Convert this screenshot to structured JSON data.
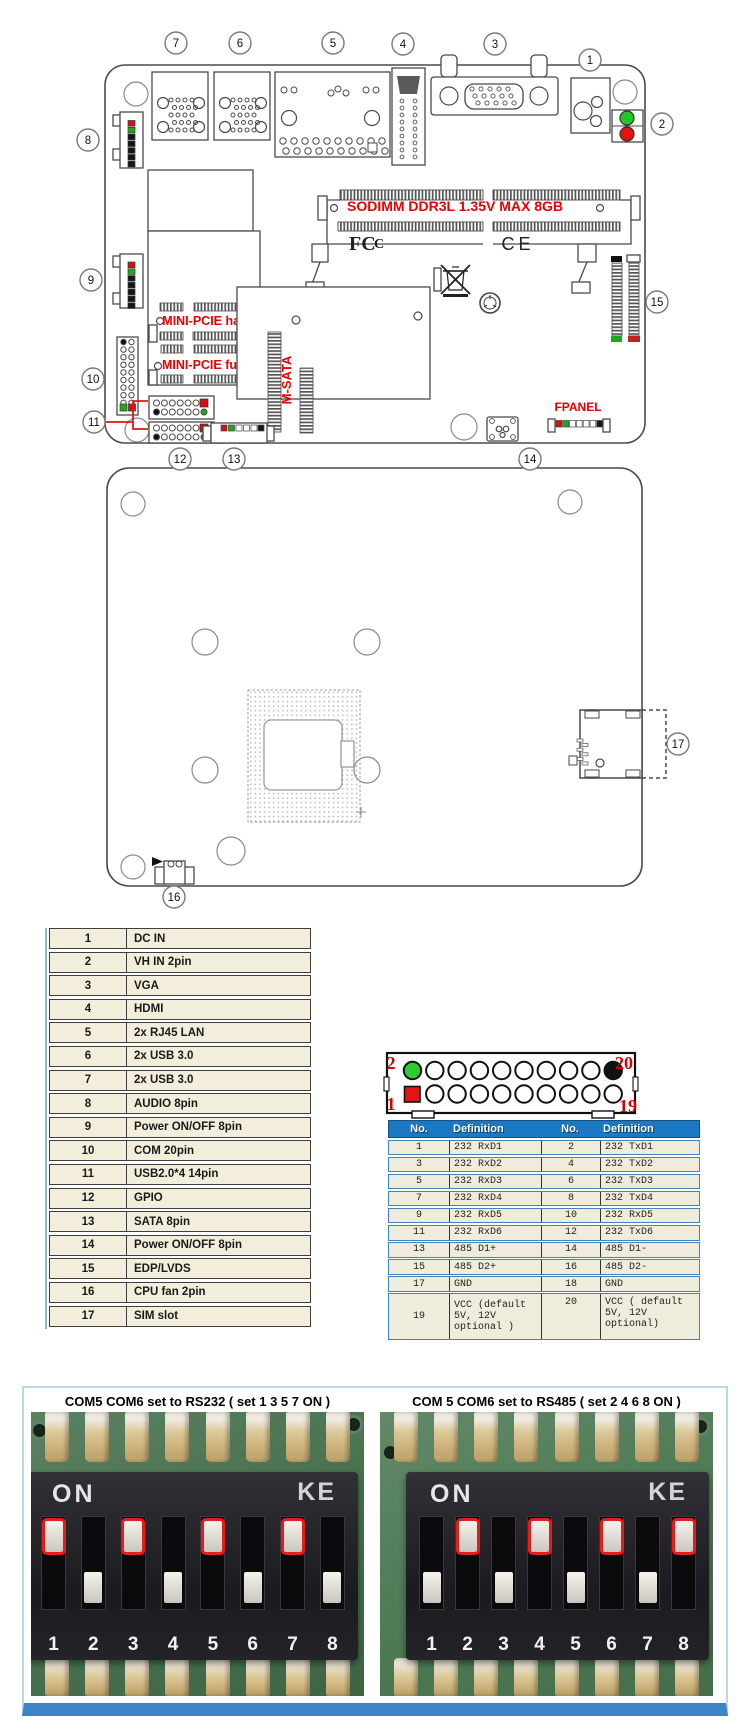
{
  "colors": {
    "label_red": "#e80000",
    "line_gray": "#4a4a4a",
    "led_green": "#22c52a",
    "led_red": "#e51212",
    "pin_green": "#2ecc2e",
    "pin_red": "#e51515",
    "table_beige": "#f2eedb",
    "header_blue": "#1a79c2"
  },
  "board_top": {
    "sodimm_label": "SODIMM DDR3L 1.35V MAX  8GB",
    "mini_pcie_half_label": "MINI-PCIE half",
    "mini_pcie_full_label": "MINI-PCIE full",
    "msata_label": "M-SATA",
    "fpanel_label": "FPANEL",
    "fcc_label": "FCC",
    "ce_label": "CE",
    "callouts": [
      {
        "n": "1",
        "x": 590,
        "y": 60
      },
      {
        "n": "2",
        "x": 662,
        "y": 124
      },
      {
        "n": "3",
        "x": 495,
        "y": 44
      },
      {
        "n": "4",
        "x": 403,
        "y": 44
      },
      {
        "n": "5",
        "x": 333,
        "y": 43
      },
      {
        "n": "6",
        "x": 240,
        "y": 43
      },
      {
        "n": "7",
        "x": 176,
        "y": 43
      },
      {
        "n": "8",
        "x": 88,
        "y": 140
      },
      {
        "n": "9",
        "x": 91,
        "y": 280
      },
      {
        "n": "10",
        "x": 93,
        "y": 379
      },
      {
        "n": "11",
        "x": 94,
        "y": 422
      },
      {
        "n": "12",
        "x": 180,
        "y": 459
      },
      {
        "n": "13",
        "x": 234,
        "y": 459
      },
      {
        "n": "14",
        "x": 530,
        "y": 459
      },
      {
        "n": "15",
        "x": 657,
        "y": 302
      }
    ]
  },
  "board_bottom": {
    "callouts": [
      {
        "n": "16",
        "x": 174,
        "y": 897
      },
      {
        "n": "17",
        "x": 678,
        "y": 744
      }
    ]
  },
  "item_table": {
    "rows": [
      {
        "no": "1",
        "name": "DC IN"
      },
      {
        "no": "2",
        "name": "VH IN 2pin"
      },
      {
        "no": "3",
        "name": "VGA"
      },
      {
        "no": "4",
        "name": "HDMI"
      },
      {
        "no": "5",
        "name": "2x RJ45 LAN"
      },
      {
        "no": "6",
        "name": "2x USB 3.0"
      },
      {
        "no": "7",
        "name": "2x USB 3.0"
      },
      {
        "no": "8",
        "name": "AUDIO 8pin"
      },
      {
        "no": "9",
        "name": "Power ON/OFF 8pin"
      },
      {
        "no": "10",
        "name": "COM 20pin"
      },
      {
        "no": "11",
        "name": "USB2.0*4 14pin"
      },
      {
        "no": "12",
        "name": "GPIO"
      },
      {
        "no": "13",
        "name": "SATA 8pin"
      },
      {
        "no": "14",
        "name": "Power ON/OFF 8pin"
      },
      {
        "no": "15",
        "name": "EDP/LVDS"
      },
      {
        "no": "16",
        "name": "CPU fan 2pin"
      },
      {
        "no": "17",
        "name": "SIM slot"
      }
    ]
  },
  "pin_header": {
    "corner_labels": {
      "top_left": "2",
      "top_right": "20",
      "bottom_left": "1",
      "bottom_right": "19"
    }
  },
  "pin_table": {
    "headers": [
      "No.",
      "Definition",
      "No.",
      "Definition"
    ],
    "rows": [
      {
        "no1": "1",
        "def1": "232 RxD1",
        "no2": "2",
        "def2": "232 TxD1",
        "tall": false
      },
      {
        "no1": "3",
        "def1": "232 RxD2",
        "no2": "4",
        "def2": "232 TxD2",
        "tall": false
      },
      {
        "no1": "5",
        "def1": "232 RxD3",
        "no2": "6",
        "def2": "232 TxD3",
        "tall": false
      },
      {
        "no1": "7",
        "def1": "232 RxD4",
        "no2": "8",
        "def2": "232 TxD4",
        "tall": false
      },
      {
        "no1": "9",
        "def1": "232 RxD5",
        "no2": "10",
        "def2": "232 RxD5",
        "tall": false
      },
      {
        "no1": "11",
        "def1": "232 RxD6",
        "no2": "12",
        "def2": "232 TxD6",
        "tall": false
      },
      {
        "no1": "13",
        "def1": "485 D1+",
        "no2": "14",
        "def2": "485 D1-",
        "tall": false
      },
      {
        "no1": "15",
        "def1": "485 D2+",
        "no2": "16",
        "def2": "485 D2-",
        "tall": false
      },
      {
        "no1": "17",
        "def1": "GND",
        "no2": "18",
        "def2": "GND",
        "tall": false
      },
      {
        "no1": "19",
        "def1": "VCC (default 5V, 12V optional )",
        "no2": "20",
        "def2": "VCC ( default 5V, 12V optional)",
        "tall": true
      }
    ]
  },
  "dip_panel": {
    "left": {
      "title": "COM5 COM6 set to RS232 ( set 1 3 5 7 ON )",
      "on_label": "ON",
      "brand": "KE",
      "numbers": [
        "1",
        "2",
        "3",
        "4",
        "5",
        "6",
        "7",
        "8"
      ],
      "set_on": [
        1,
        3,
        5,
        7
      ]
    },
    "right": {
      "title": "COM 5 COM6 set to RS485 ( set 2 4 6 8 ON )",
      "on_label": "ON",
      "brand": "KE",
      "numbers": [
        "1",
        "2",
        "3",
        "4",
        "5",
        "6",
        "7",
        "8"
      ],
      "set_on": [
        2,
        4,
        6,
        8
      ]
    }
  }
}
